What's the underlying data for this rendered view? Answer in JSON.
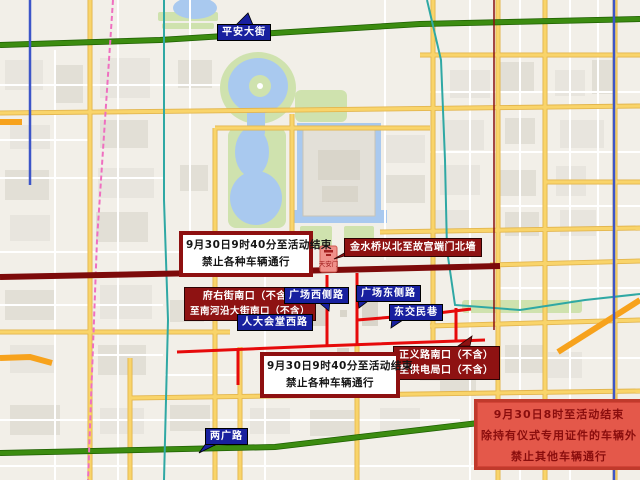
{
  "map": {
    "labels": {
      "pingan": "平安大街",
      "guangchang_xice": "广场西侧路",
      "guangchang_dongce": "广场东侧路",
      "rendahuitang_xilu": "人大会堂西路",
      "dongjiaominxiang": "东交民巷",
      "liangguanglu": "两广路"
    },
    "landmark": {
      "tiananmen": "天安门"
    },
    "colors": {
      "background": "#f2efe8",
      "water": "#a9c9ef",
      "park": "#cfe2ae",
      "major_road_yellow": "#f9d46a",
      "green_road": "#3c8c10",
      "restricted_road_red": "#e60a0a",
      "changan_avenue_maroon": "#7d0a0a",
      "subway_teal": "#2fa8a4",
      "subway_blue": "#3c55c8",
      "subway_pink_dashed": "#ef6fc0",
      "orange_road": "#f7a21c",
      "label_navy": "#18209f",
      "label_maroon": "#8e1212",
      "notice_border": "#8e1010",
      "permit_box_bg": "#e4584a",
      "permit_box_text": "#8a0d0d"
    }
  },
  "notices": {
    "top_box": {
      "line1": "9月30日9时40分至活动结束",
      "line2": "禁止各种车辆通行"
    },
    "bottom_box": {
      "line1": "9月30日9时40分至活动结束",
      "line2": "禁止各种车辆通行"
    },
    "jinshuiqiao": "金水桥以北至故宫端门北墙",
    "fuyou": {
      "line1": "府右街南口（不含）",
      "line2": "至南河沿大街南口（不含）"
    },
    "zhengyi": {
      "line1": "正义路南口（不含）",
      "line2": "至供电局口（不含）"
    },
    "permit": {
      "line1": "9月30日8时至活动结束",
      "line2": "除持有仪式专用证件的车辆外",
      "line3": "禁止其他车辆通行"
    }
  }
}
